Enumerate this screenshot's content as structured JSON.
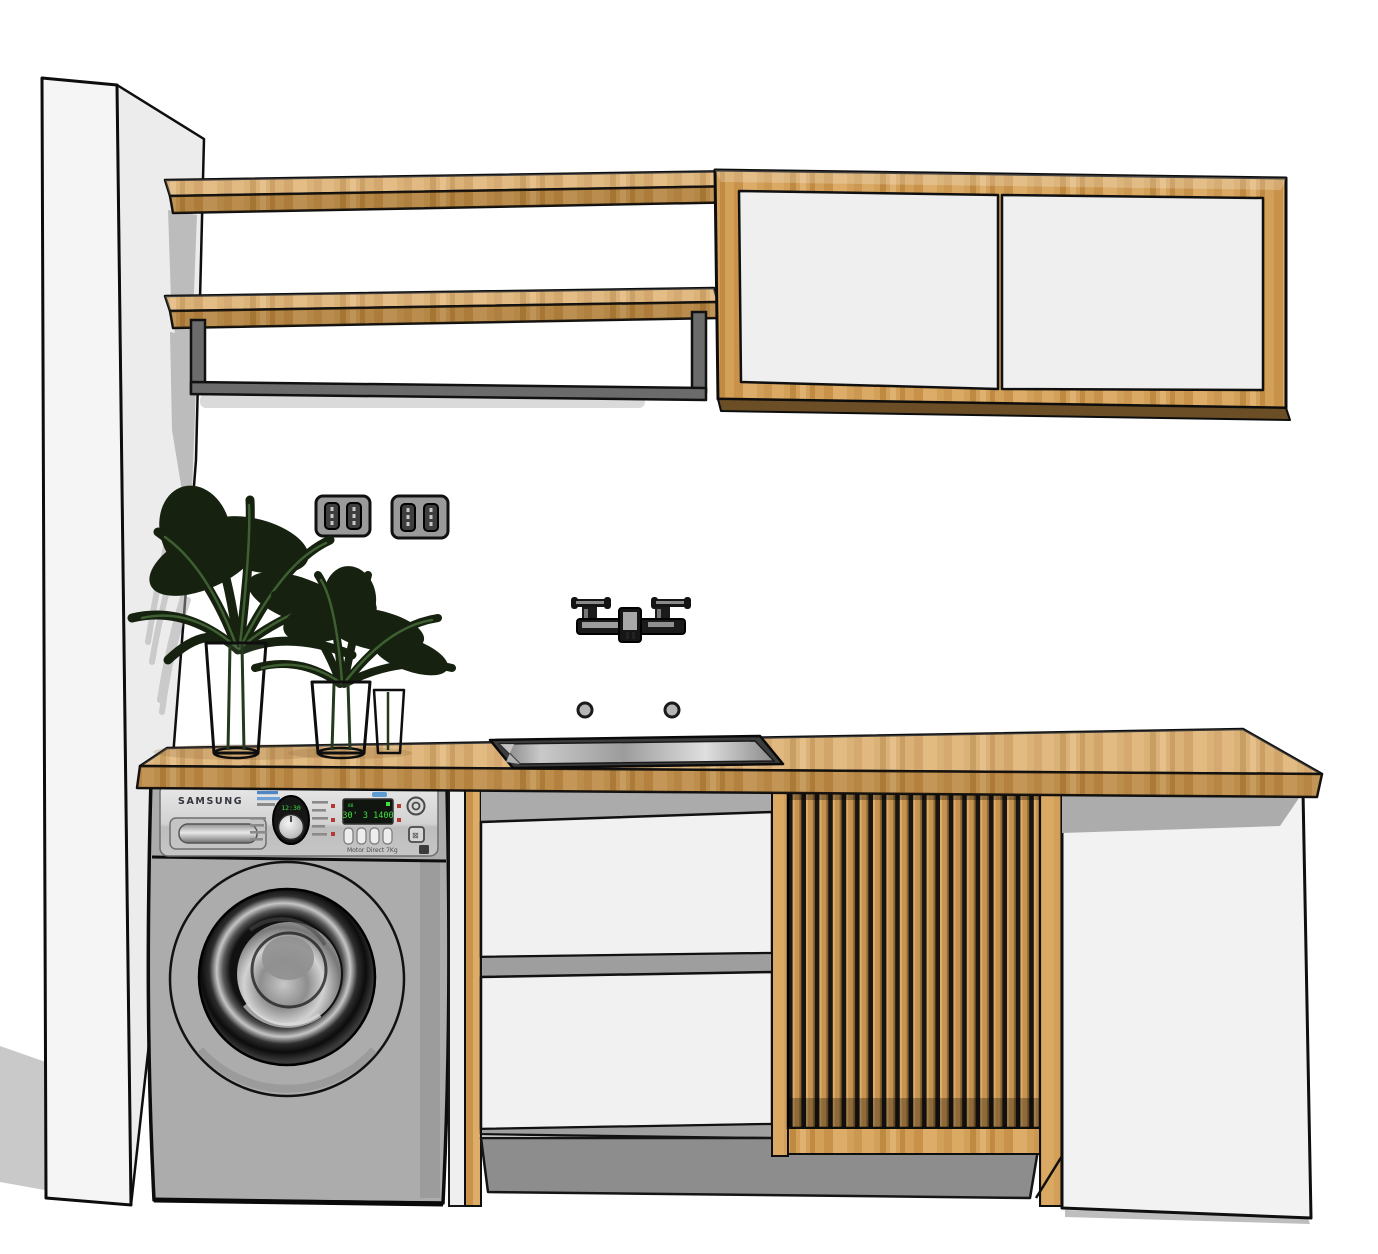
{
  "scene": {
    "description_labels": {
      "washer": "washing-machine",
      "sink": "inset-sink",
      "faucet": "wall-faucet",
      "cabinet": "wall-cabinet",
      "slat_door": "slatted-cabinet-door"
    }
  },
  "washer": {
    "brand": "SAMSUNG",
    "dial_display": "12:30",
    "panel_display": "30' 3 1400",
    "panel_display_left_badge": "88",
    "model_label": "Motor Direct 7Kg"
  },
  "colors": {
    "wood": "#D2A058",
    "wood_dark": "#B07F3E",
    "wood_shadow": "#6B4E26",
    "wall": "#FFFFFF",
    "pillar_front": "#F5F5F5",
    "pillar_side": "#ECECEC",
    "cabinet_white": "#F0F0F0",
    "washer_gray": "#ACACAC",
    "panel_gray": "#D8D8D8",
    "bracket_gray": "#6B6B6B",
    "toe_kick_gray": "#8D8D8D",
    "floor_shadow": "#C9C9C9",
    "led_green": "#3FE23F",
    "plant_green_dark": "#16220F",
    "plant_green_light": "#3E5F32",
    "outline": "#0E0E0E",
    "accent_blue": "#4D86C4",
    "accent_red": "#B23A34"
  }
}
